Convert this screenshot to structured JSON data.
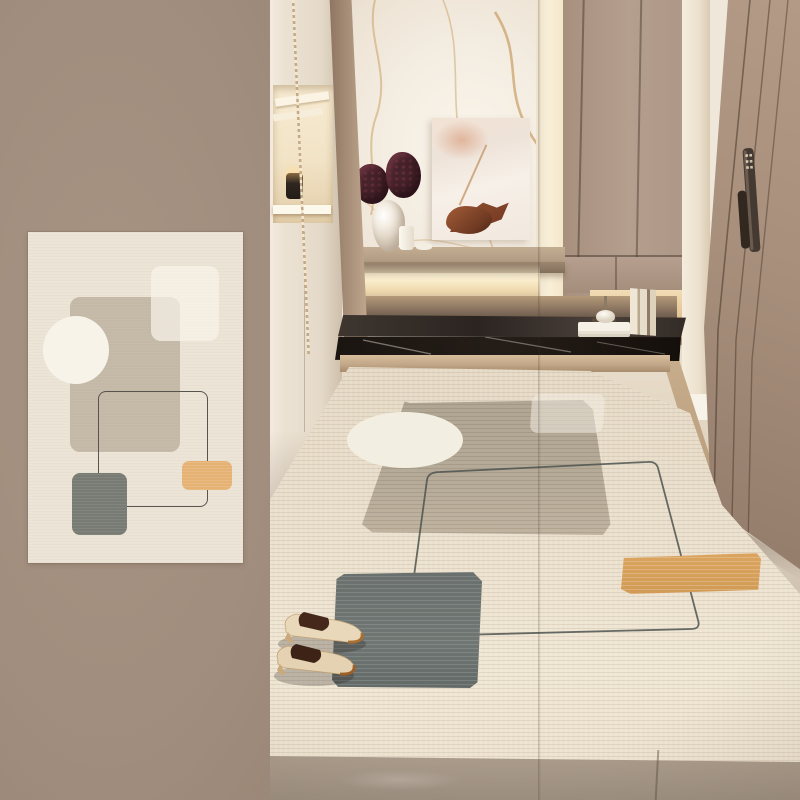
{
  "image": {
    "type": "product-photograph",
    "subject": "abstract geometric entryway rug shown as flat swatch and styled in a hallway",
    "visible_text": "",
    "swatch_panel": {
      "label": "flat rug design swatch",
      "background_color": "#a18d7d",
      "card_color": "#ece4d6",
      "shapes": [
        {
          "name": "beige-square",
          "color": "#c4b8a6"
        },
        {
          "name": "light-overlay-square",
          "color": "#f8f3e9"
        },
        {
          "name": "white-circle",
          "color": "#f8f3e9"
        },
        {
          "name": "outline-rectangle",
          "color": "#56544c"
        },
        {
          "name": "slate-gray-square",
          "color": "#787b74"
        },
        {
          "name": "orange-rectangle",
          "color": "#e5b274"
        }
      ]
    },
    "room_photo": {
      "label": "entryway with marble wall, taupe cabinets, black stone bench and rug",
      "objects": [
        {
          "name": "marble-accent-wall",
          "color": "#f4ede2"
        },
        {
          "name": "backlit-led-glow",
          "color": "#f9ecca"
        },
        {
          "name": "abstract-art-canvas",
          "color": "#f1e8df"
        },
        {
          "name": "floating-shelf",
          "color": "#b19b82"
        },
        {
          "name": "sculptural-vase",
          "color": "#f3ece1"
        },
        {
          "name": "plum-flower-clusters",
          "color": "#46222b"
        },
        {
          "name": "black-marble-bench",
          "color": "#241d18"
        },
        {
          "name": "taupe-wardrobe",
          "color": "#b49e8d"
        },
        {
          "name": "entry-door-with-smart-lock",
          "color": "#a78f7c"
        },
        {
          "name": "area-rug",
          "color": "#eadfcc"
        },
        {
          "name": "heeled-mule-shoes",
          "color": "#e9d8ba"
        },
        {
          "name": "stone-tile-floor",
          "color": "#cec0ae"
        }
      ],
      "rug_pattern_colors": {
        "taupe_square": "#b6ab98",
        "white_circle": "#f3eee2",
        "slate_square": "#6f7673",
        "orange_rectangle": "#dba55f",
        "outline_line": "#4d5350"
      }
    }
  }
}
